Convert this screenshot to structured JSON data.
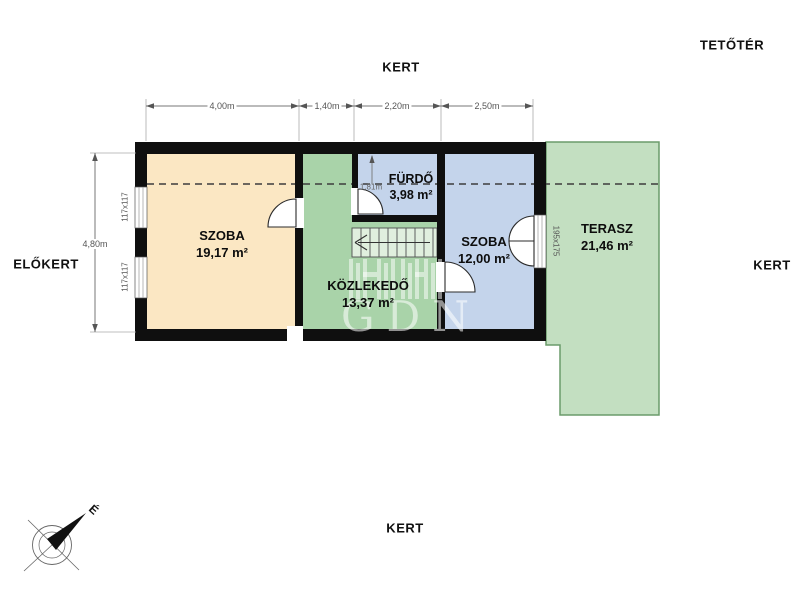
{
  "floor_label": "TETŐTÉR",
  "surroundings": {
    "top": "KERT",
    "right": "KERT",
    "bottom": "KERT",
    "left": "ELŐKERT"
  },
  "rooms": {
    "szoba_large": {
      "name": "SZOBA",
      "area": "19,17 m²"
    },
    "kozlekedo": {
      "name": "KÖZLEKEDŐ",
      "area": "13,37 m²"
    },
    "furdo": {
      "name": "FÜRDŐ",
      "area": "3,98 m²"
    },
    "szoba_small": {
      "name": "SZOBA",
      "area": "12,00 m²"
    },
    "terasz": {
      "name": "TERASZ",
      "area": "21,46 m²"
    }
  },
  "dimensions": {
    "top": [
      "4,00m",
      "1,40m",
      "2,20m",
      "2,50m"
    ],
    "left_height": "4,80m",
    "bath": "1,81m"
  },
  "openings": {
    "window_label": "117x117",
    "terrace_door_label": "195x175"
  },
  "compass": {
    "north": "É"
  },
  "watermark": {
    "text": "GDN"
  },
  "colors": {
    "room_tan": "#FBE7C3",
    "room_green": "#A9D3A9",
    "room_blue": "#C4D4EB",
    "terrace_fill": "#C3DFC1",
    "terrace_border": "#6B9B6B",
    "wall": "#0F0F0F",
    "background": "#FFFFFF"
  }
}
